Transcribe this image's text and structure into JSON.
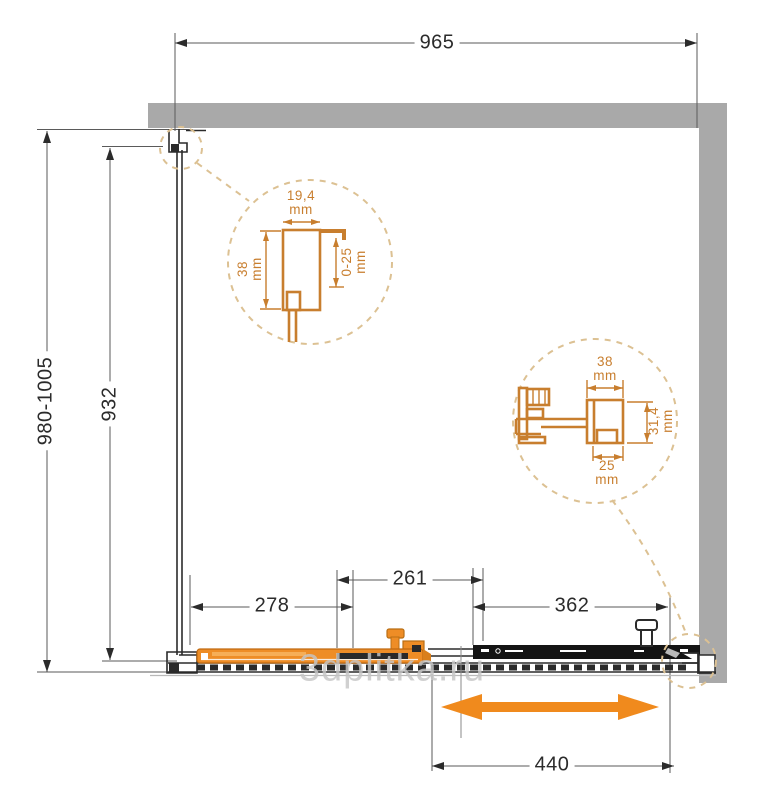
{
  "watermark": "3dplitka.ru",
  "dims": {
    "width_top": "965",
    "height_total": "980-1005",
    "height_glass": "932",
    "door_overlap": "278",
    "door_mid": "261",
    "fixed_panel": "362",
    "opening": "440"
  },
  "detail_wall_profile": {
    "width": "19,4\nmm",
    "height": "38\nmm",
    "adjustment": "0-25\nmm"
  },
  "detail_rail_profile": {
    "width": "38\nmm",
    "channel": "25\nmm",
    "height": "31,4\nmm"
  },
  "colors": {
    "accent_orange": "#EE8D26",
    "accent_orange_light": "#F6AE57",
    "arrow_orange": "#F08A1D",
    "detail_orange": "#C87E2E",
    "dash_tan": "#DCC193",
    "wall_gray": "#A9A9A9",
    "line_dark": "#2B2B2B",
    "line_thin": "#5A5A5A",
    "watermark_gray": "#C6C6C6"
  }
}
